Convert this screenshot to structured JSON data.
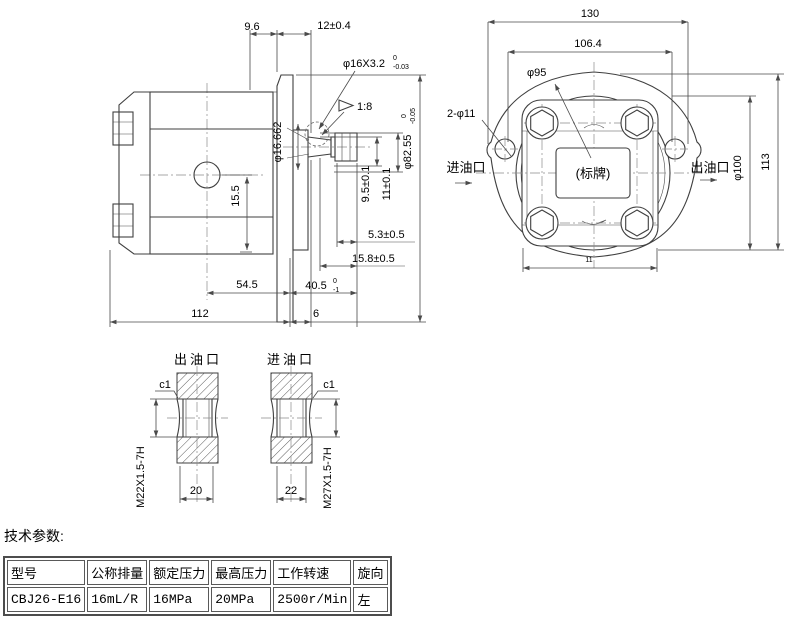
{
  "side_view": {
    "dim_top_left": "9.6",
    "dim_top_right": "12±0.4",
    "spline_base": "φ16X3.2",
    "spline_tol_upper": "0",
    "spline_tol_lower": "-0.03",
    "taper_ratio": "1:8",
    "taper_dia": "φ16.662",
    "dim_hole": "15.5",
    "dim_key_a": "9.5±0.1",
    "dim_key_b": "11±0.1",
    "flange_dia_base": "φ82.55",
    "flange_dia_tol_upper": "0",
    "flange_dia_tol_lower": "-0.05",
    "dim_5_3": "5.3±0.5",
    "dim_15_8": "15.8±0.5",
    "dim_54_5": "54.5",
    "dim_40_5_base": "40.5",
    "dim_40_5_tol_upper": "0",
    "dim_40_5_tol_lower": "-1",
    "dim_112": "112",
    "dim_6": "6"
  },
  "front_view": {
    "dim_130": "130",
    "dim_106_4": "106.4",
    "pilot_dia": "φ95",
    "mount_holes": "2-φ11",
    "inlet": "进油口",
    "outlet": "出油口",
    "nameplate": "(标牌)",
    "body_dia": "φ100",
    "dim_113": "113",
    "dim_body_width": "11"
  },
  "ports": {
    "outlet_label": "出油口",
    "inlet_label": "进油口",
    "outlet_chamfer": "c1",
    "inlet_chamfer": "c1",
    "outlet_thread": "M22X1.5-7H",
    "inlet_thread": "M27X1.5-7H",
    "outlet_width": "20",
    "inlet_width": "22"
  },
  "table": {
    "title": "技术参数:",
    "headers": [
      "型号",
      "公称排量",
      "额定压力",
      "最高压力",
      "工作转速",
      "旋向"
    ],
    "row": [
      "CBJ26-E16",
      "16mL/R",
      "16MPa",
      "20MPa",
      "2500r/Min",
      "左"
    ]
  },
  "colors": {
    "line": "#3f3f3f",
    "text": "#000000",
    "table_border": "#4d4d4d",
    "bg": "#ffffff"
  }
}
